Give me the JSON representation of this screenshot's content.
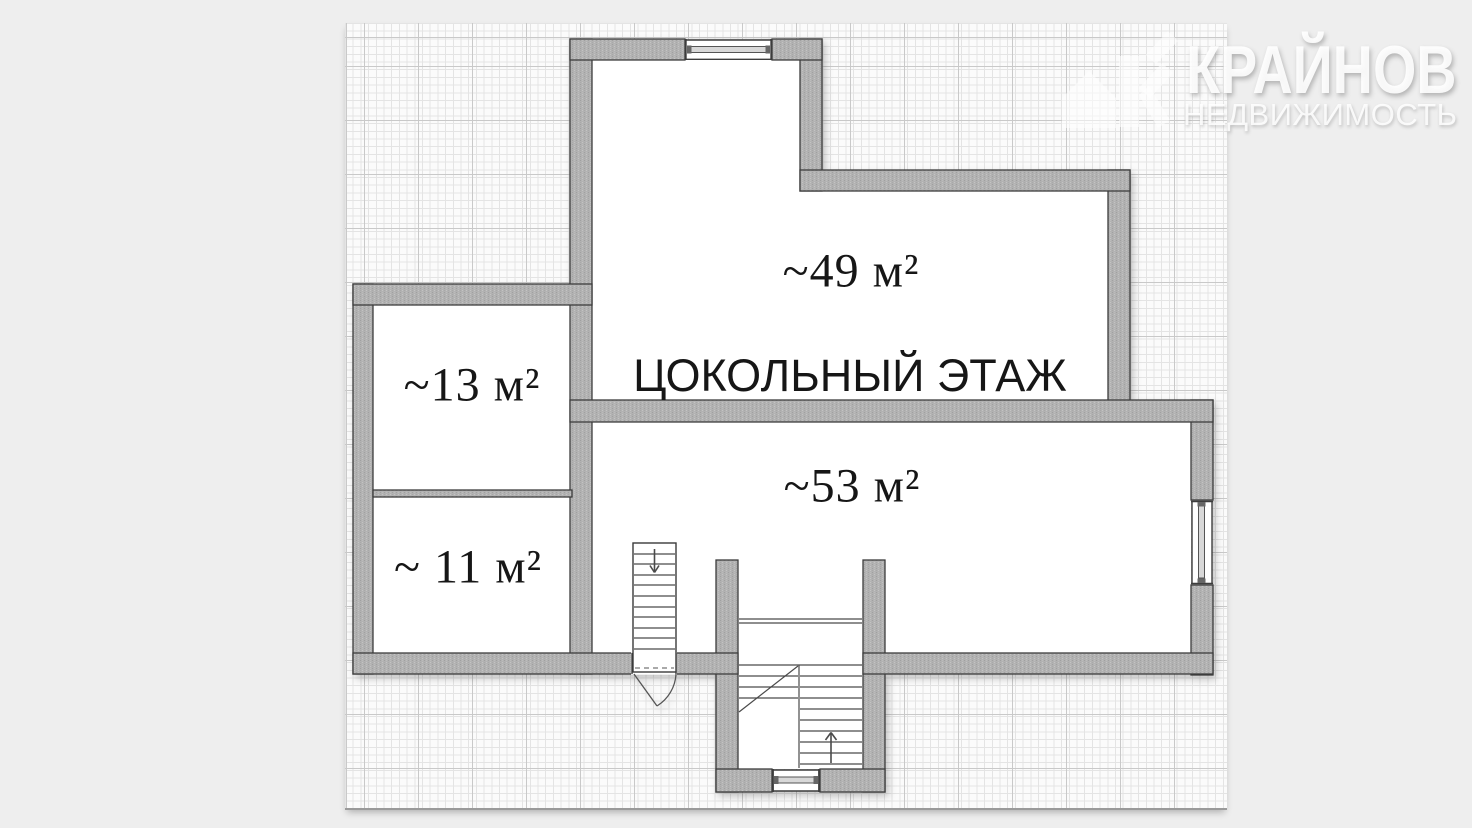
{
  "page": {
    "background_color": "#eeeeee",
    "paper_color": "#fbfbfb"
  },
  "watermark": {
    "brand": "КРАЙНОВ",
    "subtitle": "НЕДВИЖИМОСТЬ"
  },
  "floor_plan": {
    "title": "ЦОКОЛЬНЫЙ ЭТАЖ",
    "rooms": [
      {
        "name": "room-49",
        "area_label": "~49 м²"
      },
      {
        "name": "room-53",
        "area_label": "~53 м²"
      },
      {
        "name": "room-13",
        "area_label": "~13 м²"
      },
      {
        "name": "room-11",
        "area_label": "~ 11 м²"
      }
    ],
    "colors": {
      "wall_fill": "#b1b1b1",
      "wall_outline": "#3d3d3d",
      "room_fill": "#ffffff",
      "label_text": "#161616",
      "page_bg": "#eeeeee"
    }
  }
}
